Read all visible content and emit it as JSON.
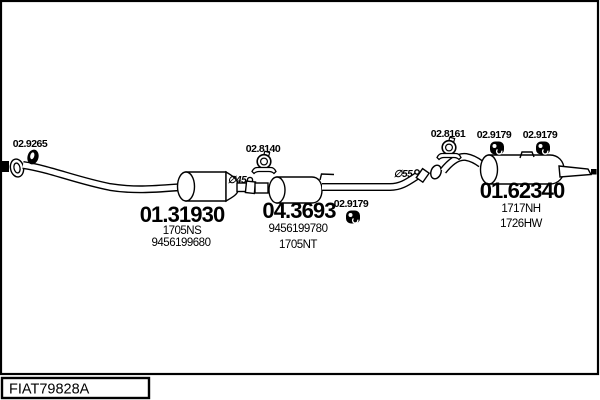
{
  "drawing_code": "FIAT79828A",
  "parts": {
    "gasket": {
      "number": "02.9265"
    },
    "clamp_mid": {
      "number": "02.8140"
    },
    "clamp_rear": {
      "number": "02.8161"
    },
    "hanger_mid": {
      "number": "02.9179"
    },
    "hanger_rear_left": {
      "number": "02.9179"
    },
    "hanger_rear_right": {
      "number": "02.9179"
    },
    "front_muffler": {
      "number": "01.31930",
      "ref1": "1705NS",
      "ref2": "9456199680"
    },
    "catalytic_converter": {
      "number": "04.3693",
      "ref1": "9456199780",
      "ref2": "1705NT"
    },
    "rear_muffler": {
      "number": "01.62340",
      "ref1": "1717NH",
      "ref2": "1726HW"
    }
  },
  "annotations": {
    "diameter_front": "∅45",
    "diameter_rear": "∅55"
  },
  "colors": {
    "line": "#000000",
    "background": "#ffffff"
  }
}
